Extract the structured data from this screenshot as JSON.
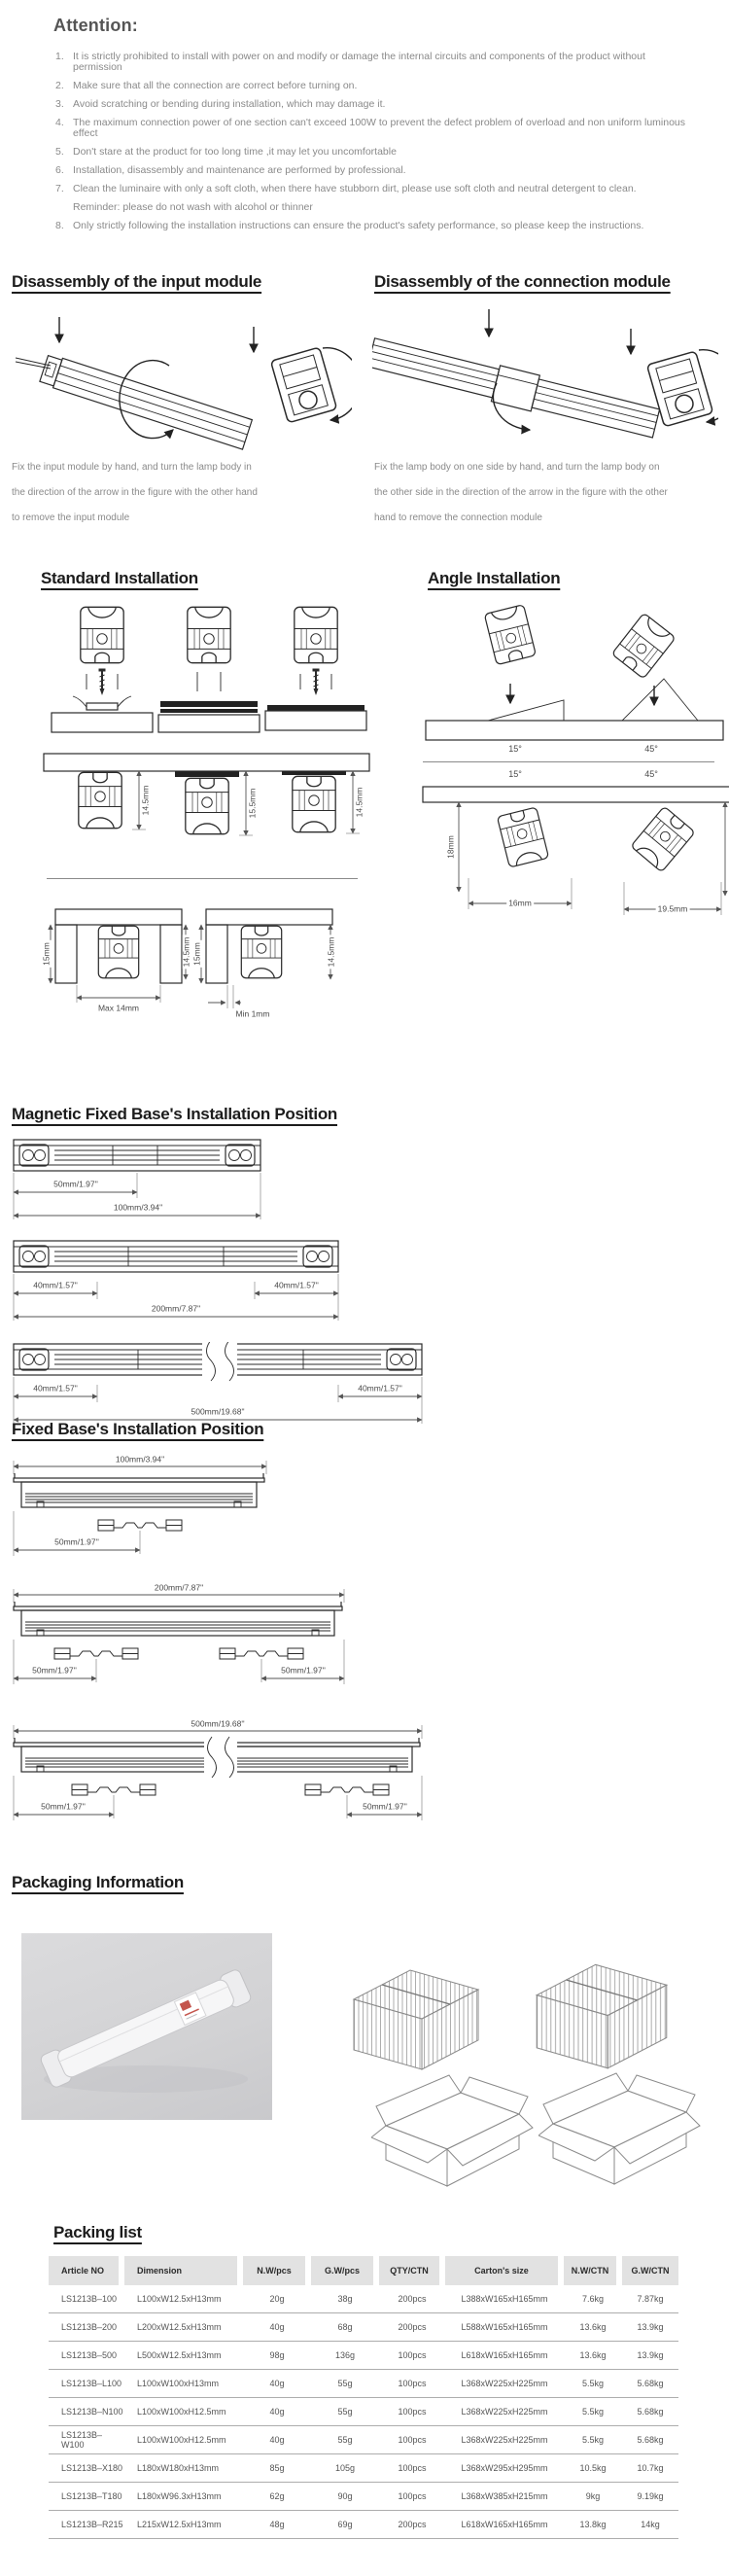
{
  "attention": {
    "title": "Attention:",
    "items": [
      "It is strictly prohibited to install with power on and modify or damage the internal circuits and components of the product without permission",
      "Make sure that all the connection are correct before turning on.",
      "Avoid scratching or bending during installation, which may damage it.",
      "The maximum connection power of one section can't exceed 100W to prevent the defect problem of overload and non uniform luminous effect",
      "Don't stare at the product for too long time ,it may let you uncomfortable",
      "Installation, disassembly and maintenance are performed by professional.",
      "Clean the luminaire with only a soft cloth, when there have stubborn dirt, please use soft cloth and neutral detergent to clean.",
      "Only strictly following the installation instructions can ensure the product's safety performance, so please keep the instructions."
    ],
    "reminder": "Reminder: please do not wash with alcohol or thinner"
  },
  "disassembly_input": {
    "title": "Disassembly of the input module",
    "description": "Fix the input module by hand, and turn the lamp body in the direction of the arrow in the figure with the other hand to remove the input module"
  },
  "disassembly_connection": {
    "title": "Disassembly of the connection module",
    "description": "Fix the lamp body on one side by hand, and turn the lamp body on the other side in the direction of the arrow in the figure with the other hand to remove the connection module"
  },
  "standard_installation": {
    "title": "Standard Installation",
    "mounted_dims": [
      "14.5mm",
      "15.5mm",
      "14.5mm"
    ],
    "recessed": [
      {
        "left": "15mm",
        "right": "14.5mm",
        "gap": "Max 14mm"
      },
      {
        "left": "15mm",
        "right": "14.5mm",
        "gap": "Min 1mm"
      }
    ]
  },
  "angle_installation": {
    "title": "Angle Installation",
    "angle_labels": [
      "15°",
      "45°"
    ],
    "tilt_dims": [
      {
        "height": "18mm",
        "width": "16mm"
      },
      {
        "height": "18.5mm",
        "width": "19.5mm"
      }
    ]
  },
  "magnetic_base": {
    "title": "Magnetic Fixed Base's Installation Position",
    "d100": {
      "half": "50mm/1.97''",
      "total": "100mm/3.94\""
    },
    "d200": {
      "left": "40mm/1.57\"",
      "right": "40mm/1.57\"",
      "total": "200mm/7.87\""
    },
    "d500": {
      "left": "40mm/1.57\"",
      "right": "40mm/1.57\"",
      "total": "500mm/19.68\""
    }
  },
  "fixed_base": {
    "title": "Fixed Base's Installation Position",
    "d100": {
      "total": "100mm/3.94\"",
      "offset": "50mm/1.97''"
    },
    "d200": {
      "total": "200mm/7.87\"",
      "left": "50mm/1.97''",
      "right": "50mm/1.97''"
    },
    "d500": {
      "total": "500mm/19.68''",
      "left": "50mm/1.97''",
      "right": "50mm/1.97''"
    }
  },
  "packaging": {
    "title": "Packaging Information"
  },
  "packing_list": {
    "title": "Packing list",
    "columns": [
      "Article NO",
      "Dimension",
      "N.W/pcs",
      "G.W/pcs",
      "QTY/CTN",
      "Carton's size",
      "N.W/CTN",
      "G.W/CTN"
    ],
    "rows": [
      [
        "LS1213B–100",
        "L100xW12.5xH13mm",
        "20g",
        "38g",
        "200pcs",
        "L388xW165xH165mm",
        "7.6kg",
        "7.87kg"
      ],
      [
        "LS1213B–200",
        "L200xW12.5xH13mm",
        "40g",
        "68g",
        "200pcs",
        "L588xW165xH165mm",
        "13.6kg",
        "13.9kg"
      ],
      [
        "LS1213B–500",
        "L500xW12.5xH13mm",
        "98g",
        "136g",
        "100pcs",
        "L618xW165xH165mm",
        "13.6kg",
        "13.9kg"
      ],
      [
        "LS1213B–L100",
        "L100xW100xH13mm",
        "40g",
        "55g",
        "100pcs",
        "L368xW225xH225mm",
        "5.5kg",
        "5.68kg"
      ],
      [
        "LS1213B–N100",
        "L100xW100xH12.5mm",
        "40g",
        "55g",
        "100pcs",
        "L368xW225xH225mm",
        "5.5kg",
        "5.68kg"
      ],
      [
        "LS1213B–W100",
        "L100xW100xH12.5mm",
        "40g",
        "55g",
        "100pcs",
        "L368xW225xH225mm",
        "5.5kg",
        "5.68kg"
      ],
      [
        "LS1213B–X180",
        "L180xW180xH13mm",
        "85g",
        "105g",
        "100pcs",
        "L368xW295xH295mm",
        "10.5kg",
        "10.7kg"
      ],
      [
        "LS1213B–T180",
        "L180xW96.3xH13mm",
        "62g",
        "90g",
        "100pcs",
        "L368xW385xH215mm",
        "9kg",
        "9.19kg"
      ],
      [
        "LS1213B–R215",
        "L215xW12.5xH13mm",
        "48g",
        "69g",
        "200pcs",
        "L618xW165xH165mm",
        "13.8kg",
        "14kg"
      ]
    ]
  }
}
